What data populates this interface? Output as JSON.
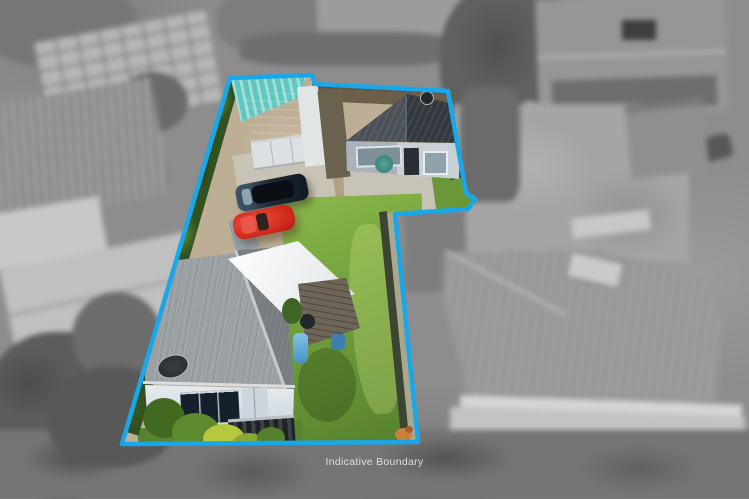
{
  "caption": {
    "label": "Indicative Boundary"
  },
  "boundary": {
    "color": "#18A7E9",
    "style": "solid cyan polygon outline; interior of boundary shown in colour, surroundings desaturated greyscale and blurred"
  },
  "property": {
    "buildings": [
      {
        "name": "main-house",
        "roof_color": "#9aa0a3",
        "wall_color": "#e2e8ec",
        "details": [
          "satellite-dish",
          "dark-ranch-slider-windows",
          "dark-steps"
        ]
      },
      {
        "name": "minor-dwelling",
        "roof_color": "#3e454b",
        "wall_color": "#c2cacf",
        "details": [
          "roof-vent",
          "dark-door",
          "framed-windows",
          "heat-pump"
        ]
      },
      {
        "name": "garage",
        "roof_color": "#8d9398",
        "wall_color": "#dce0e3"
      },
      {
        "name": "white-carport",
        "roof_color": "#f2f4f4"
      },
      {
        "name": "teal-shade-structure",
        "roof_color": "#6fcdc6"
      }
    ],
    "vehicles": [
      {
        "name": "dark-blue-wagon",
        "color": "#1d2b38"
      },
      {
        "name": "red-classic-car",
        "color": "#d32a1d"
      }
    ],
    "grounds": [
      "gravel-driveway",
      "front-lawn",
      "side-concrete-path",
      "left-boundary-hedge",
      "garden-shrubs",
      "timber-deck",
      "blue-barrels",
      "orange-dog"
    ]
  },
  "surroundings": {
    "style": "greyscale, blurred aerial context",
    "features": [
      "grid-pattern-roof",
      "ribbed-metal-roof",
      "large-hip-roof-house-with-skylight",
      "backyard-lawn-and-shed",
      "trees",
      "parked-cars"
    ]
  }
}
